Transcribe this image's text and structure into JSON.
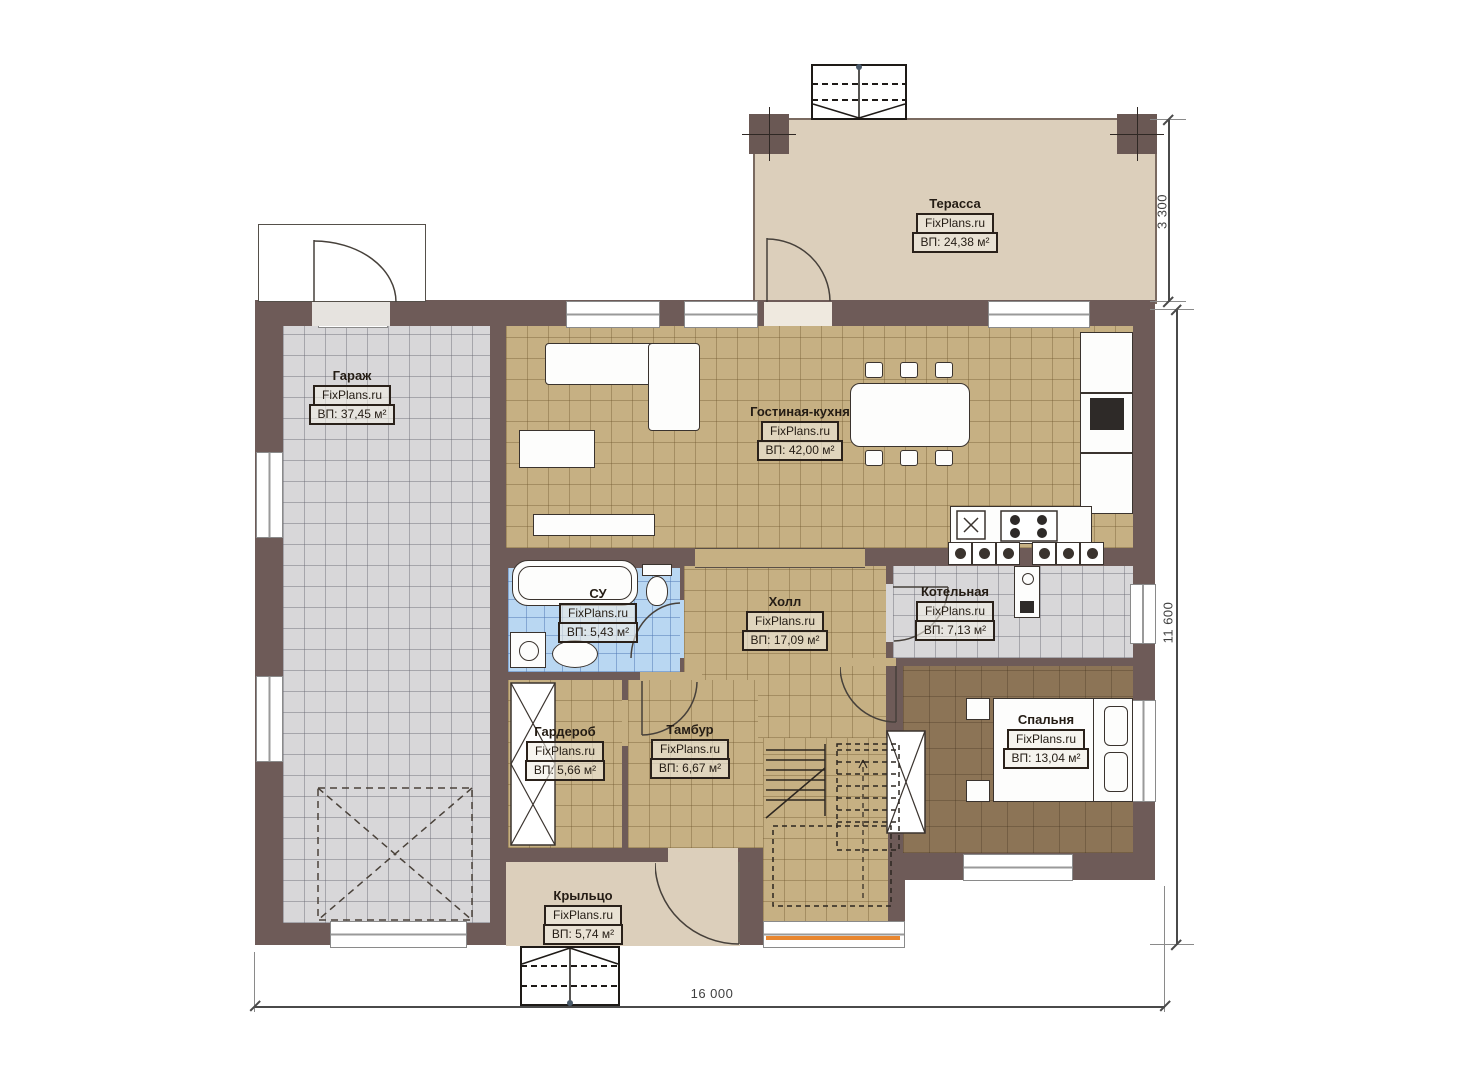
{
  "plan": {
    "watermark": "FixPlans.ru",
    "rooms": [
      {
        "id": "terrace",
        "title": "Терасса",
        "area": "ВП: 24,38 м²"
      },
      {
        "id": "garage",
        "title": "Гараж",
        "area": "ВП: 37,45 м²"
      },
      {
        "id": "living_kitchen",
        "title": "Гостиная-кухня",
        "area": "ВП: 42,00 м²"
      },
      {
        "id": "bathroom",
        "title": "СУ",
        "area": "ВП: 5,43 м²"
      },
      {
        "id": "hall",
        "title": "Холл",
        "area": "ВП: 17,09 м²"
      },
      {
        "id": "boiler",
        "title": "Котельная",
        "area": "ВП: 7,13 м²"
      },
      {
        "id": "wardrobe",
        "title": "Гардероб",
        "area": "ВП: 5,66 м²"
      },
      {
        "id": "vestibule",
        "title": "Тамбур",
        "area": "ВП: 6,67 м²"
      },
      {
        "id": "bedroom",
        "title": "Спальня",
        "area": "ВП: 13,04 м²"
      },
      {
        "id": "porch",
        "title": "Крыльцо",
        "area": "ВП: 5,74 м²"
      }
    ],
    "dimensions": {
      "terrace_depth_label": "3 300",
      "height_label": "11 600",
      "width_label": "16 000"
    },
    "colors": {
      "wall": "#6e5b58",
      "terrace_floor": "#dccfbb",
      "living_floor": "#c6b083",
      "garage_floor": "#d8d7d9",
      "bathroom_floor": "#b9d7f2",
      "bedroom_floor": "#8c7456",
      "window_sill_accent": "#e8862f"
    }
  }
}
